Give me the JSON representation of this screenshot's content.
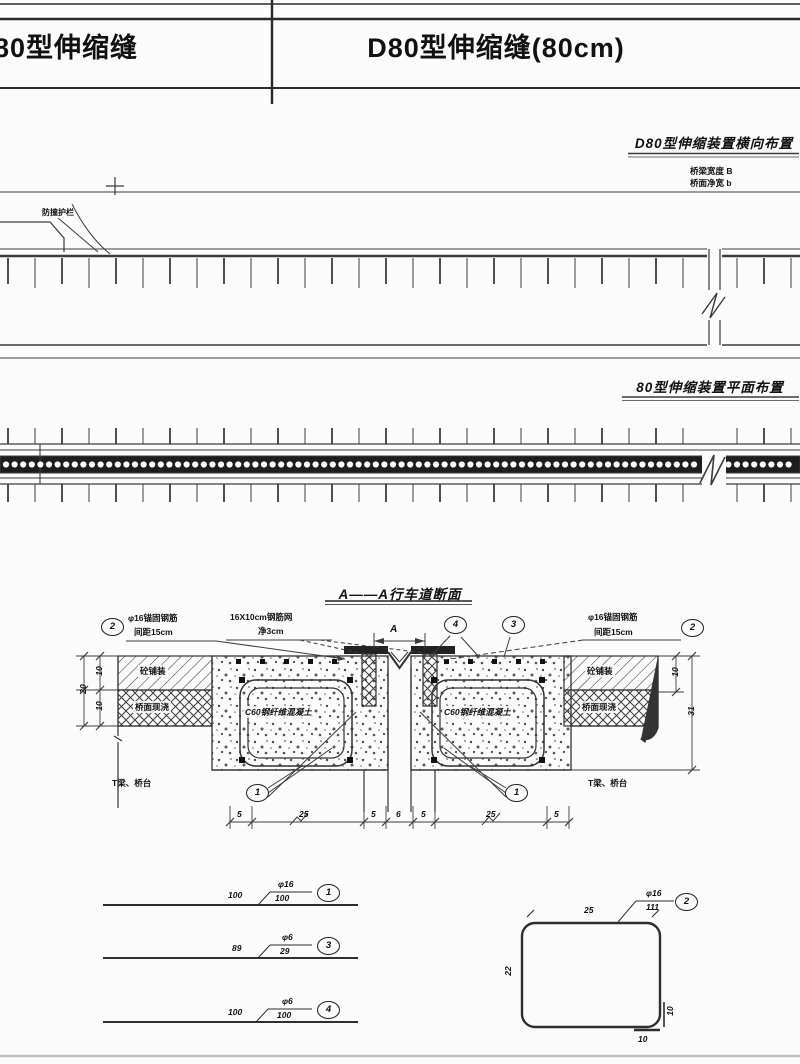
{
  "title_block": {
    "left_title": "80型伸缩缝",
    "right_title": "D80型伸缩缝(80cm)"
  },
  "transverse": {
    "title": "D80型伸缩装置横向布置",
    "note1": "桥梁宽度 B",
    "note2": "桥面净宽 b",
    "guardrail": "防撞护栏"
  },
  "plan": {
    "title": "80型伸缩装置平面布置"
  },
  "section": {
    "title": "A——A行车道断面",
    "co2l_num": "2",
    "co2l_l1": "φ16锚固钢筋",
    "co2l_l2": "间距15cm",
    "mesh_l1": "16X10cm钢筋网",
    "mesh_l2": "净3cm",
    "co4": "4",
    "co3": "3",
    "co2r_num": "2",
    "co2r_l1": "φ16锚固钢筋",
    "co2r_l2": "间距15cm",
    "pav_l": "砼铺装",
    "deck_l": "桥面现浇",
    "pav_r": "砼铺装",
    "deck_r": "桥面现浇",
    "c60_l": "C60钢纤维混凝土",
    "c60_r": "C60钢纤维混凝土",
    "beam_l": "T梁、桥台",
    "beam_r": "T梁、桥台",
    "co1l": "1",
    "co1r": "1",
    "dimA": "A",
    "dim_l_total": "20",
    "dim_l_1": "10",
    "dim_l_2": "10",
    "dim_r_1": "10",
    "dim_r_total": "31",
    "dims_bottom": [
      "5",
      "25",
      "5",
      "6",
      "5",
      "25",
      "5"
    ]
  },
  "details": {
    "bar1": {
      "dim": "100",
      "dia": "φ16",
      "len": "100",
      "num": "1"
    },
    "bar3": {
      "dim": "89",
      "dia": "φ6",
      "len": "29",
      "num": "3"
    },
    "bar4": {
      "dim": "100",
      "dia": "φ6",
      "len": "100",
      "num": "4"
    },
    "bar2": {
      "num": "2",
      "dia": "φ16",
      "len": "111",
      "top": "25",
      "left": "22",
      "bottom": "10",
      "right": "10"
    }
  }
}
